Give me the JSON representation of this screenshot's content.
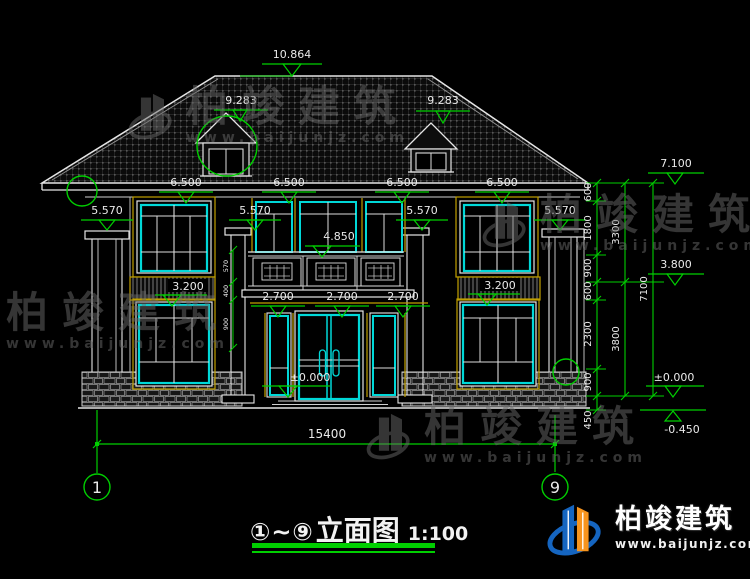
{
  "title": {
    "range": "①~⑨",
    "name": "立面图",
    "scale": "1:100"
  },
  "axis": {
    "left": "1",
    "right": "9"
  },
  "brand": {
    "name": "柏竣建筑",
    "site": "www.baijunjz.com"
  },
  "levels": {
    "ridge": "10.864",
    "dormer_left": "9.283",
    "dormer_right": "9.283",
    "eave": [
      "6.500",
      "6.500",
      "6.500",
      "6.500"
    ],
    "col": [
      "5.570",
      "5.570",
      "5.570",
      "5.570"
    ],
    "balcony": "4.850",
    "band": [
      "3.200",
      "3.200"
    ],
    "lintel": [
      "2.700",
      "2.700",
      "2.700"
    ],
    "ground": "±0.000",
    "right_top": "7.100",
    "right_mid": "3.800",
    "right_zero": "±0.000",
    "right_neg": "-0.450"
  },
  "dims": {
    "total": "15400",
    "small": [
      "600",
      "1800",
      "900",
      "600",
      "2300",
      "900",
      "450"
    ],
    "mid": [
      "3300",
      "3800"
    ],
    "overall": "7100",
    "mini": [
      "570",
      "400",
      "900"
    ]
  },
  "colors": {
    "dim_green": "#00cf00",
    "window_cyan": "#00d8d8",
    "trim_yellow": "#c0a000",
    "logo_blue": "#1565c0",
    "logo_orange": "#f7941d"
  }
}
